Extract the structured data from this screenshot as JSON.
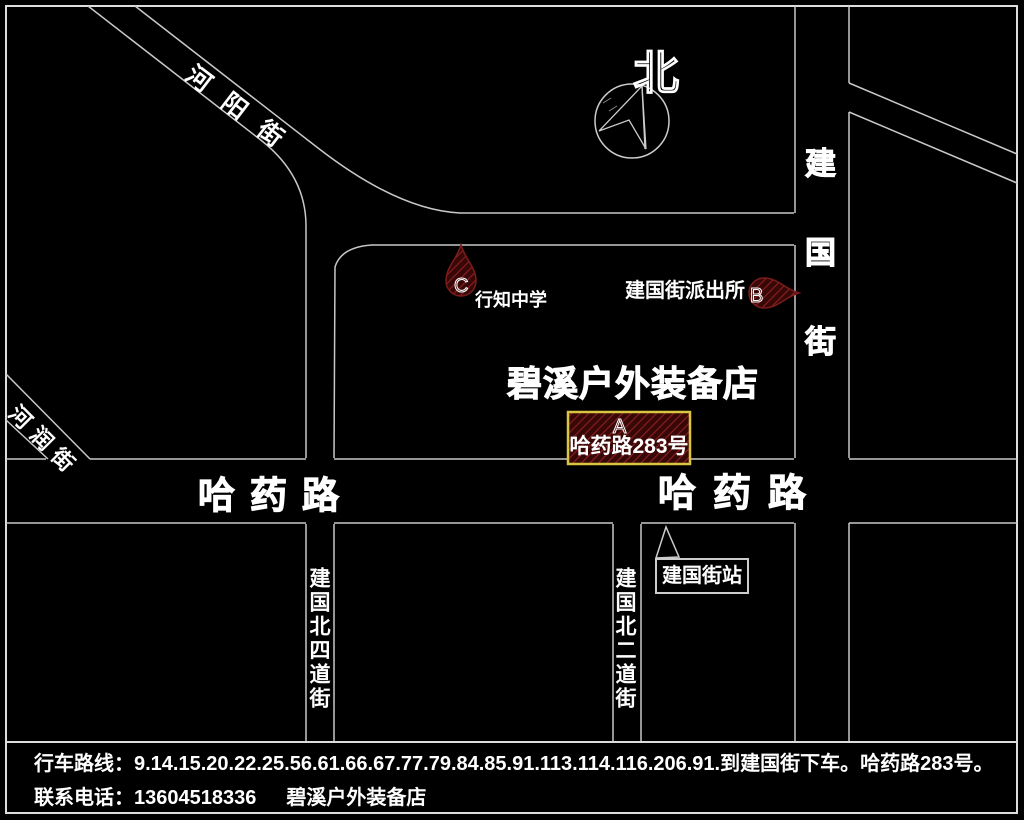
{
  "map": {
    "compass_label": "北",
    "store_title": "碧溪户外装备店",
    "streets": {
      "heyang": "河阳街",
      "herun": "河润街",
      "hayao_left": "哈药路",
      "hayao_right": "哈药路",
      "jianguo": "建国街",
      "jianguo_bei_si": "建国北四道街",
      "jianguo_bei_er": "建国北二道街"
    },
    "markers": {
      "a": {
        "letter": "A",
        "label": "哈药路283号"
      },
      "b": {
        "letter": "B",
        "label": "建国街派出所"
      },
      "c": {
        "letter": "C",
        "label": "行知中学"
      },
      "station": {
        "label": "建国街站"
      }
    },
    "colors": {
      "background": "#000000",
      "road_line": "#c8c8c8",
      "text": "#ffffff",
      "marker_fill": "#380808",
      "marker_hatch": "#8b2020",
      "marker_outline": "#7c1c1c",
      "a_box_border": "#d9c53f"
    }
  },
  "footer": {
    "route_line": "行车路线：9.14.15.20.22.25.56.61.66.67.77.79.84.85.91.113.114.116.206.91.到建国街下车。哈药路283号。",
    "phone_label": "联系电话：",
    "phone_number": "13604518336",
    "store_name": "碧溪户外装备店"
  }
}
